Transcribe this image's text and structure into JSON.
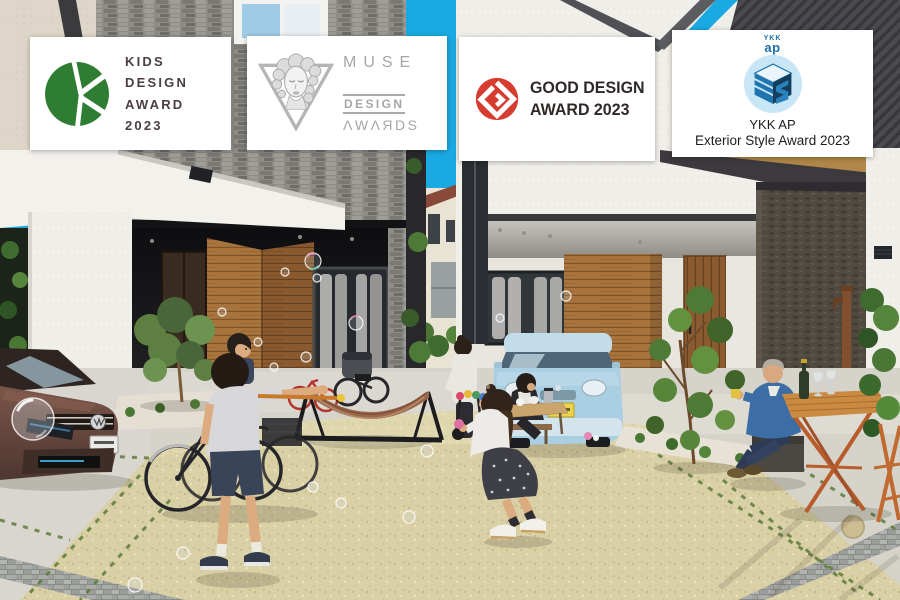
{
  "badges": [
    {
      "name": "kids-design-award-2023",
      "logo_icon": "kids-design-k-logo",
      "logo_color": "#2f7d33",
      "text_color": "#4b3e3e",
      "lines": [
        "KIDS",
        "DESIGN",
        "AWARD",
        "2023"
      ]
    },
    {
      "name": "muse-design-awards",
      "logo_icon": "muse-face-triangle-logo",
      "logo_color": "#b0b0b0",
      "text_color": "#a6a6a6",
      "lines": [
        "MUSE",
        "DESIGN",
        "ΛWΛЯDS"
      ]
    },
    {
      "name": "good-design-award-2023",
      "logo_icon": "g-mark-logo",
      "logo_color": "#d63c30",
      "text_color": "#2f2827",
      "lines": [
        "GOOD DESIGN",
        "AWARD 2023"
      ]
    },
    {
      "name": "ykk-ap-exterior-style-award-2023",
      "logo_icon": "es-cube-logo",
      "logo_color": "#1b6fa8",
      "text_color": "#1d1d1d",
      "logo_caption_top": "YKK",
      "logo_caption_bottom": "ap",
      "lines": [
        "YKK AP",
        "Exterior Style Award 2023"
      ]
    }
  ],
  "photo": {
    "description": "Modern houses with dark stone and wood facades around a shared beige gravel courtyard; a boy blows soap bubbles, a girl chases them, parents relax at outdoor tables; a brown hatchback and a light-blue kei car are parked; bicycles and a hammock stand by the entrance",
    "colors": {
      "sky": "#1ba9e3",
      "stone_wall": "#8e8c87",
      "dark_roof": "#4b4b4f",
      "white_wall": "#f2f0ea",
      "wood_panel": "#a8743e",
      "gravel_court": "#d9d0a6",
      "brown_car": "#6e4c41",
      "blue_car": "#aacfe2",
      "hammock": "#9a674c",
      "orange_table": "#c98a42"
    }
  }
}
